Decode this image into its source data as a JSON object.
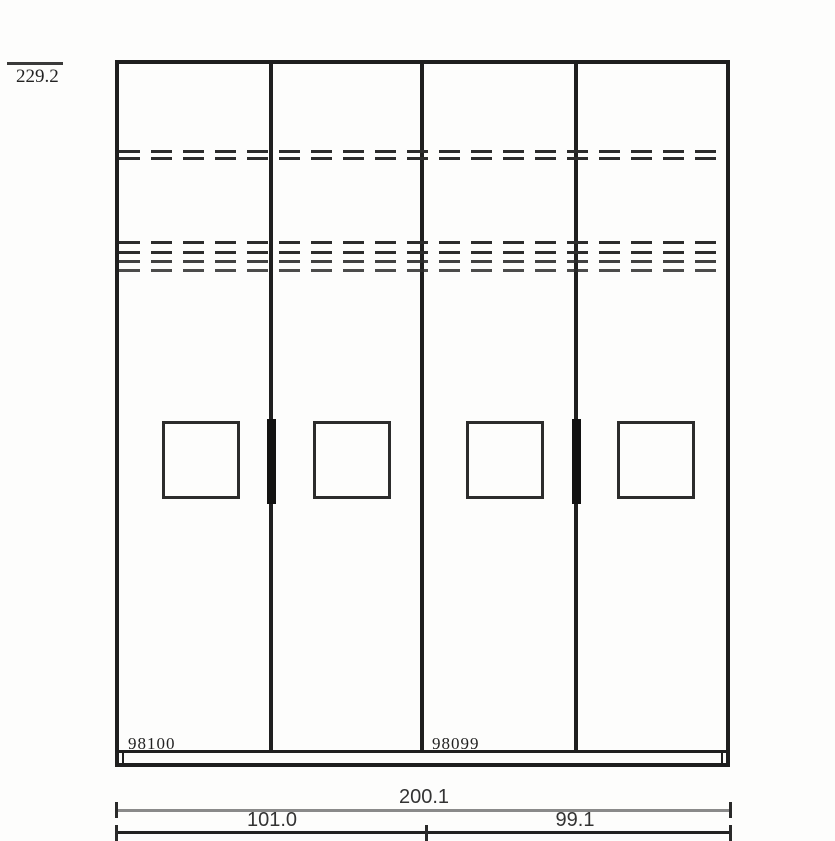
{
  "drawing": {
    "height_dimension": "229.2",
    "articles": {
      "left": "98100",
      "right": "98099"
    },
    "width_dimensions": {
      "total": "200.1",
      "left": "101.0",
      "right": "99.1"
    },
    "edge_mark": ")"
  },
  "colors": {
    "line": "#1f1f1f",
    "line_soft": "#2c2c2c",
    "dim_line_total": "#8a8a8a",
    "dim_line_split": "#222222",
    "background": "#fdfdfc",
    "text": "#222222"
  }
}
